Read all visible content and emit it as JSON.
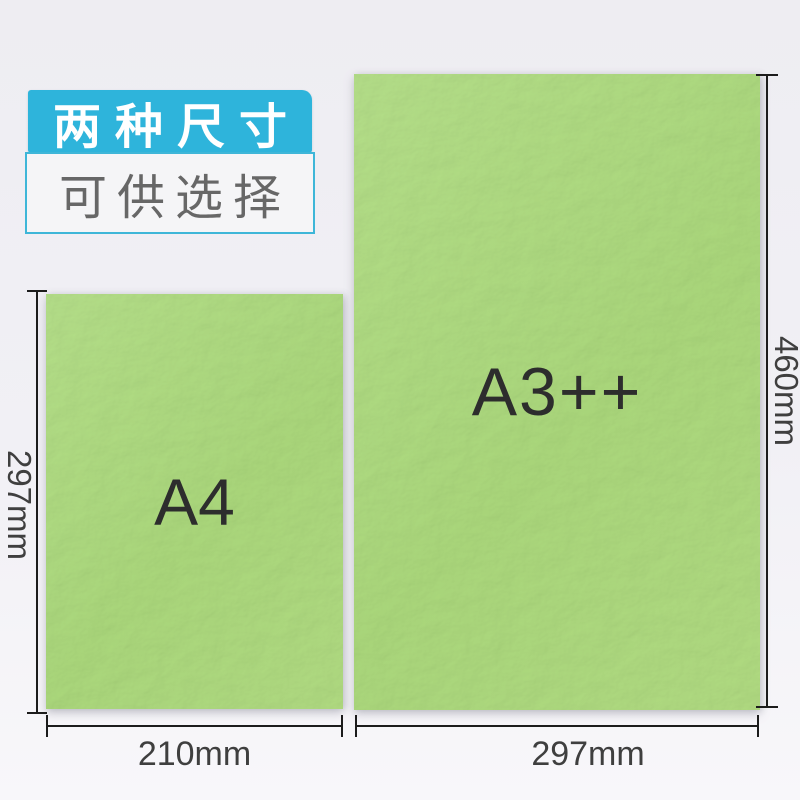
{
  "badge": {
    "line1": "两种尺寸",
    "line2": "可供选择"
  },
  "papers": [
    {
      "id": "a4",
      "label": "A4",
      "width_label": "210mm",
      "height_label": "297mm"
    },
    {
      "id": "a3pp",
      "label": "A3++",
      "width_label": "297mm",
      "height_label": "460mm"
    }
  ],
  "colors": {
    "accent": "#2eb4db",
    "badge_border": "#3eb6d8",
    "subtitle_text": "#676767",
    "paper_green": "#a9d67a",
    "label_text": "#2d2d2d",
    "dim_line": "#1c1c1c",
    "dim_text": "#3f3f3f"
  }
}
